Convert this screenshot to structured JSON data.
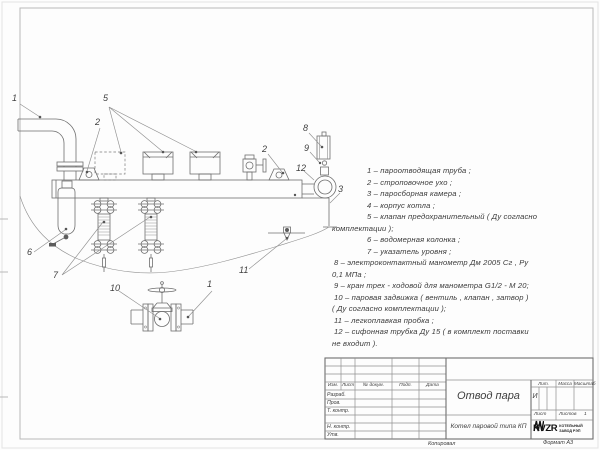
{
  "sheet": {
    "copied_label": "Копировал",
    "format_label": "Формат А3"
  },
  "parts": {
    "lines": [
      "1 –  пароотводящая труба ;",
      "2 –  строповочное ухо ;",
      "3 –  паросборная камера ;",
      "4 –  корпус котла ;",
      "5 –  клапан предохранительный  ( Ду согласно",
      "комплектации );",
      "6 –  водомерная колонка ;",
      "7 – указатель уровня ;",
      "8 – электроконтактный манометр  Дм 2005 Сг ,  Ру",
      "0,1 МПа ;",
      "9 –  кран трех - ходовой для манометра   G1/2 - М 20;",
      "10 –  паровая задвижка  ( вентиль ,  клапан ,  затвор )",
      "( Ду согласно комплектации );",
      "11 –  легкоплавкая пробка ;",
      "12 –  сифонная трубка Ду 15 ( в комплект поставки",
      "не входит )."
    ]
  },
  "drawing": {
    "callouts": [
      "1",
      "5",
      "2",
      "2",
      "8",
      "9",
      "12",
      "3",
      "6",
      "7",
      "10",
      "1",
      "11"
    ]
  },
  "titleblock": {
    "doc_title": "Отвод пара",
    "product": "Котел паровой типа КП",
    "header_cells": [
      "Изм.",
      "Лист",
      "№ докум.",
      "Подп.",
      "Дата"
    ],
    "staff": [
      "Разраб.",
      "Пров.",
      "Т. контр.",
      "Н. контр.",
      "Утв."
    ],
    "lit_label": "Лит.",
    "mass_label": "Масса",
    "scale_label": "Масштаб",
    "lit_value": "И",
    "sheet_label": "Лист",
    "sheets_label": "Листов",
    "sheets_value": "1",
    "company": {
      "name": "KVZR",
      "line1": "КОТЕЛЬНЫЙ",
      "line2": "ЗАВОД РЭП"
    }
  },
  "colors": {
    "drawing_line": "#6e6e6e",
    "frame": "#b9b9b9",
    "text": "#3a3a3a"
  }
}
